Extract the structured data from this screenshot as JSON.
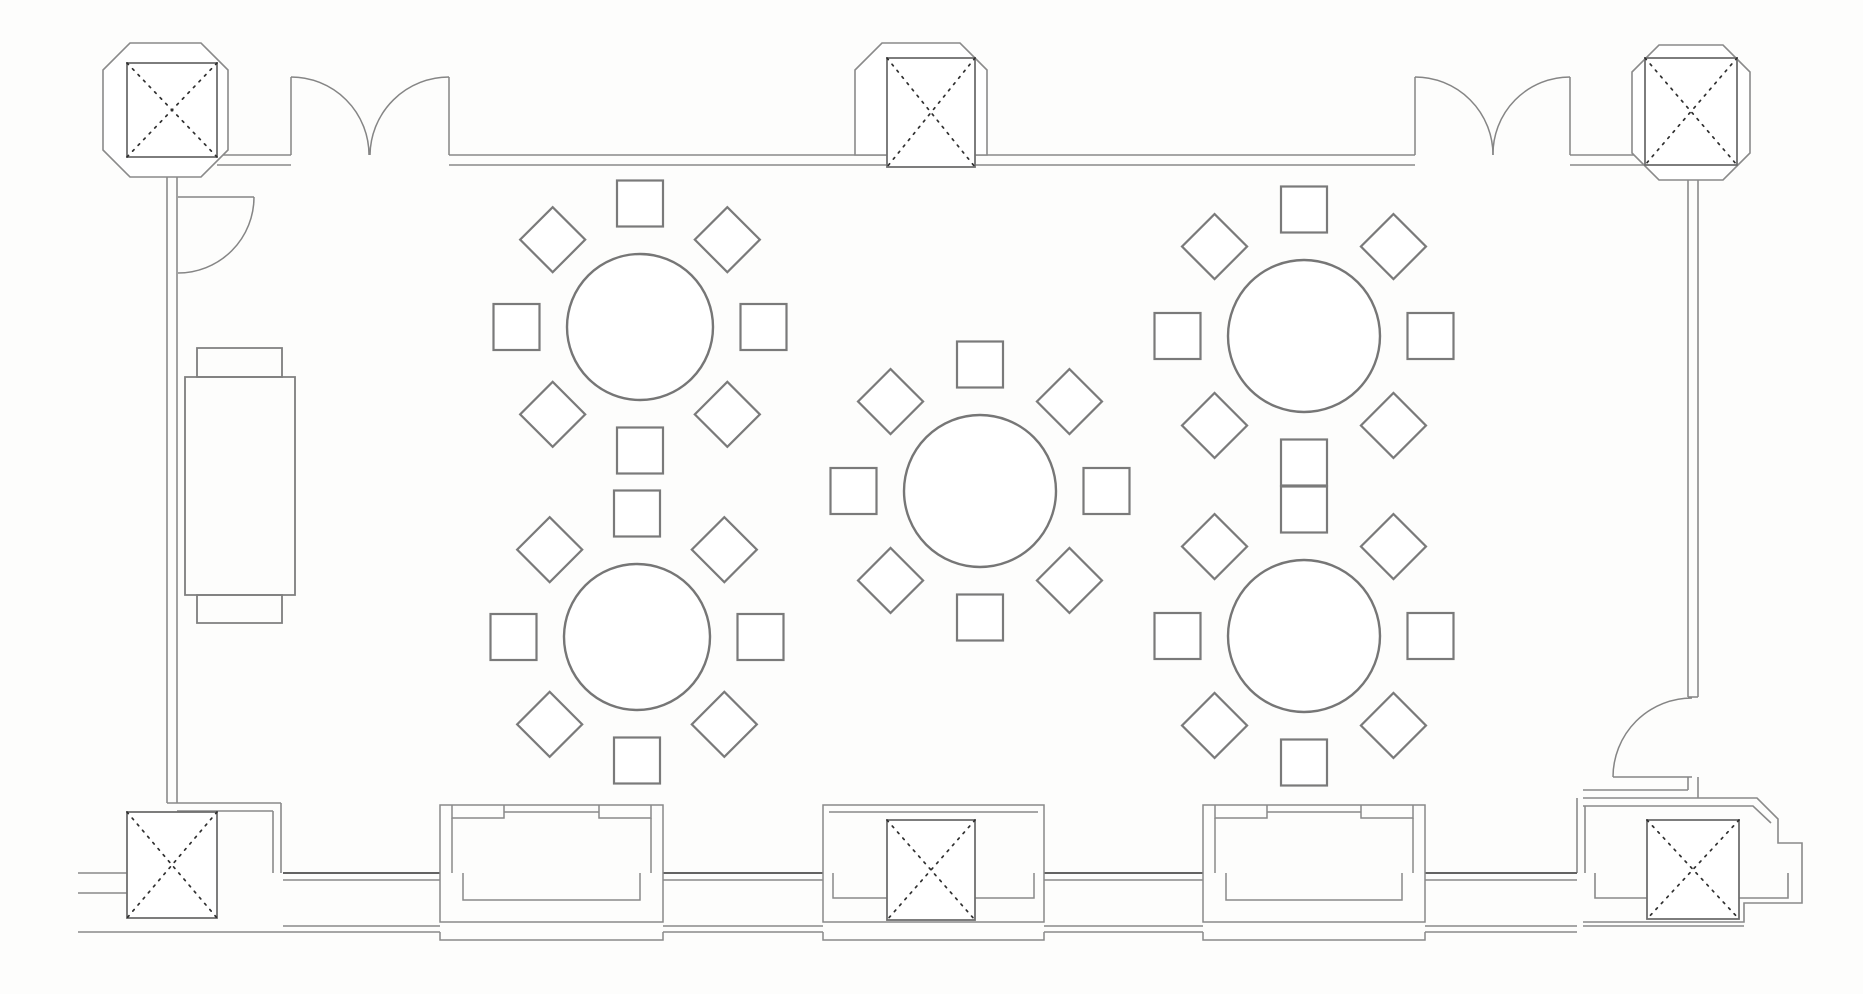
{
  "canvas": {
    "width": 1863,
    "height": 994,
    "background": "#fdfdfc"
  },
  "palette": {
    "wall_line": "#8a8a8a",
    "dark_wall_line": "#636363",
    "furniture_line": "#7a7a7a",
    "column_brace_line": "#2f2f2f",
    "fill": "#ffffff"
  },
  "floorplan": {
    "tables": [
      {
        "id": "table-1",
        "cx": 640,
        "cy": 327,
        "r": 73
      },
      {
        "id": "table-2",
        "cx": 1304,
        "cy": 336,
        "r": 76
      },
      {
        "id": "table-3",
        "cx": 980,
        "cy": 491,
        "r": 76
      },
      {
        "id": "table-4",
        "cx": 637,
        "cy": 637,
        "r": 73
      },
      {
        "id": "table-5",
        "cx": 1304,
        "cy": 636,
        "r": 76
      }
    ],
    "seating": {
      "chairs_per_table": 8,
      "chair_size": 46,
      "chair_gap": 31
    },
    "columns": [
      {
        "id": "column-top-left",
        "x": 127,
        "y": 63,
        "w": 90,
        "h": 94,
        "ring": "M130,43 H201 L228,70 V150 L201,177 H130 L103,150 V70 Z"
      },
      {
        "id": "column-top-middle",
        "x": 887,
        "y": 58,
        "w": 88,
        "h": 109,
        "ring": "M882,43 H960 L987,70 V155 H855 V70 Z"
      },
      {
        "id": "column-top-right",
        "x": 1645,
        "y": 58,
        "w": 92,
        "h": 107,
        "ring": "M1659,45 H1723 L1750,72 V153 L1723,180 H1659 L1632,153 V72 Z"
      },
      {
        "id": "column-bottom-left",
        "x": 127,
        "y": 812,
        "w": 90,
        "h": 106
      },
      {
        "id": "column-bottom-middle",
        "x": 887,
        "y": 820,
        "w": 88,
        "h": 100
      },
      {
        "id": "column-bottom-right",
        "x": 1647,
        "y": 820,
        "w": 92,
        "h": 99
      }
    ],
    "walls": [
      "M217,155 H291",
      "M217,165 H291",
      "M449,155 H887",
      "M449,165 H887",
      "M975,155 H1415",
      "M975,165 H1415",
      "M1570,155 H1645",
      "M1570,165 H1645",
      "M167,157 V803",
      "M177,167 V803",
      "M167,803 H281",
      "M177,811 H273",
      "M281,803 V873",
      "M273,811 V873",
      "M1688,165 V697",
      "M1698,165 V697",
      "M1688,697 H1698",
      "M78,873 H127",
      "M78,893 H127",
      "M78,932 H283",
      "M1583,790 H1688",
      "M1583,798 H1757 L1778,819 V843 H1802 V903 H1744 V922 H1583",
      "M1583,806 H1753 L1771,823",
      "M1688,777 V790",
      "M1698,777 V798",
      "M1577,798 V873",
      "M1585,806 V873",
      "M1583,926 H1744",
      "M1595,873 V898 H1647",
      "M1739,898 H1788 V873"
    ],
    "wall_segments_bottom": [
      {
        "x1": 283,
        "x2": 440
      },
      {
        "x1": 663,
        "x2": 823
      },
      {
        "x1": 1044,
        "x2": 1203
      },
      {
        "x1": 1425,
        "x2": 1577
      }
    ],
    "bays": [
      {
        "id": "window-bay-left",
        "x": 440,
        "w": 223,
        "kind": "window"
      },
      {
        "id": "column-bay-middle",
        "x": 823,
        "w": 221,
        "kind": "column",
        "cut1": 887,
        "cut2": 975
      },
      {
        "id": "window-bay-right",
        "x": 1203,
        "w": 222,
        "kind": "window"
      }
    ],
    "bay_metrics": {
      "top": 805,
      "inner_top": 812,
      "band": 873,
      "bottom": 922,
      "under": 940,
      "notch_inset": 12,
      "notch_w": 52,
      "notch_h": 13,
      "u_inset": 23,
      "u_bottom": 900
    },
    "doors": [
      {
        "id": "double-door-top-left",
        "paths": [
          "M291,155 V77",
          "M449,155 V77",
          "M291,77 A78,78 0 0 1 369,155",
          "M449,77 A79,79 0 0 0 370,155"
        ]
      },
      {
        "id": "double-door-top-right",
        "paths": [
          "M1415,155 V77",
          "M1570,155 V77",
          "M1415,77 A78,78 0 0 1 1493,155",
          "M1570,77 A77,77 0 0 0 1493,155"
        ]
      },
      {
        "id": "single-door-left",
        "paths": [
          "M178,197 H254",
          "M254,197 A76,76 0 0 1 178,273"
        ]
      },
      {
        "id": "single-door-bottom-right",
        "paths": [
          "M1613,777 H1692",
          "M1613,777 A79,79 0 0 1 1692,698"
        ]
      }
    ],
    "buffet": {
      "id": "buffet-table",
      "paths": [
        "M185,377 H295 V595 H185 Z",
        "M197,348 H282 V377 H197 Z",
        "M197,595 H282 V623 H197 Z"
      ]
    }
  }
}
